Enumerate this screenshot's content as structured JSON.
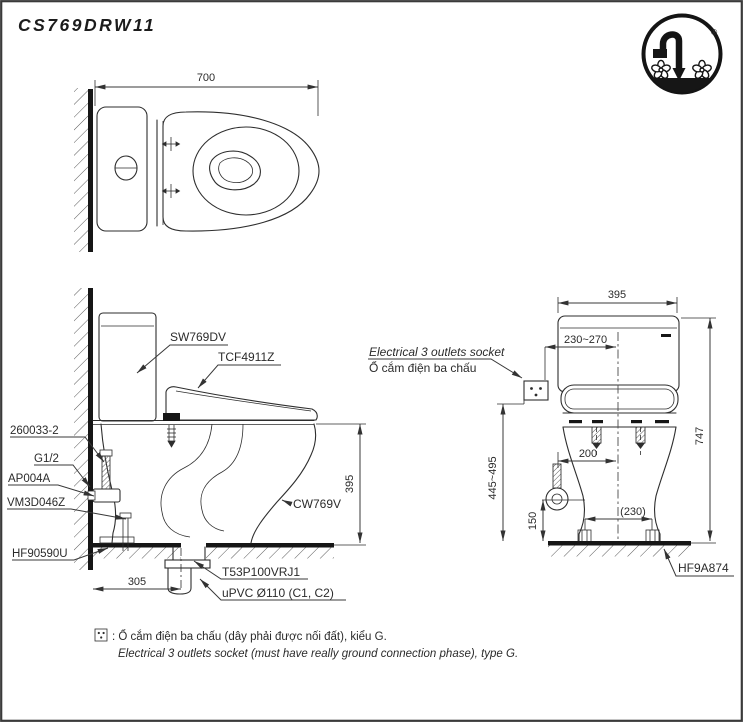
{
  "title": "CS769DRW11",
  "logo": {
    "registered": "®"
  },
  "views": {
    "top": {
      "dims": {
        "depth": "700"
      }
    },
    "side": {
      "parts": {
        "tank": "SW769DV",
        "washlet": "TCF4911Z",
        "supply_hose": "260033-2",
        "thread": "G1/2",
        "stop_valve": "AP004A",
        "connector": "VM3D046Z",
        "floor_flange": "HF90590U",
        "bowl": "CW769V",
        "drain_joint": "T53P100VRJ1",
        "drain_pipe": "uPVC Ø110 (C1, C2)"
      },
      "dims": {
        "rim_height": "395",
        "drain_set_out": "305"
      }
    },
    "front": {
      "labels": {
        "socket_en": "Electrical 3 outlets socket",
        "socket_vi": "Ổ cắm điện ba chấu",
        "floor_set": "HF9A874"
      },
      "dims": {
        "width": "395",
        "socket_offset": "230~270",
        "total_height": "747",
        "socket_height": "445~495",
        "supply_offset": "200",
        "supply_height": "150",
        "bolt_spacing": "(230)"
      }
    }
  },
  "footnote": {
    "line1": ": Ổ cắm điện ba chấu (dây phải được nối đất), kiểu G.",
    "line2": "Electrical 3 outlets socket (must have really ground connection phase), type G."
  },
  "colors": {
    "line": "#2e2e2e",
    "text": "#2b2b2b",
    "background": "#ffffff"
  }
}
